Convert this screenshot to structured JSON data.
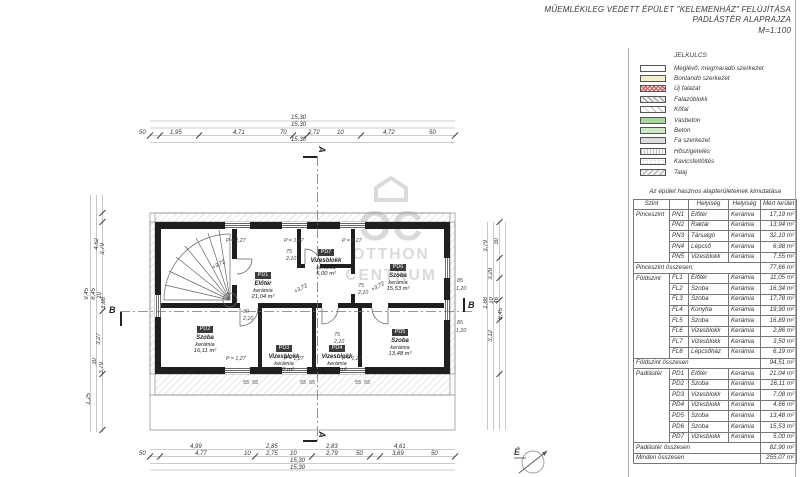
{
  "title": {
    "line1": "MŰEMLÉKILEG VÉDETT ÉPÜLET \"KELEMENHÁZ\" FELÚJÍTÁSA",
    "line2": "PADLÁSTÉR ALAPRAJZA",
    "line3": "M=1:100"
  },
  "legend": {
    "title": "JELKULCS",
    "items": [
      {
        "label": "Meglévő, megmaradó szerkezet",
        "swatch": "sw-existing"
      },
      {
        "label": "Bontandó szerkezet",
        "swatch": "sw-demolish"
      },
      {
        "label": "Új falazat",
        "swatch": "sw-newwall"
      },
      {
        "label": "Falazóblokk",
        "swatch": "sw-block"
      },
      {
        "label": "Kőfal",
        "swatch": "sw-stone"
      },
      {
        "label": "Vasbeton",
        "swatch": "sw-rc"
      },
      {
        "label": "Beton",
        "swatch": "sw-concrete"
      },
      {
        "label": "Fa szerkezet",
        "swatch": "sw-wood"
      },
      {
        "label": "Hőszigetelés",
        "swatch": "sw-insul"
      },
      {
        "label": "Kavicsfeltöltés",
        "swatch": "sw-gravel"
      },
      {
        "label": "Talaj",
        "swatch": "sw-soil"
      }
    ]
  },
  "area_table": {
    "title": "Az épület hasznos alapterületeinek kimutatása",
    "headers": [
      "Szint",
      "",
      "Helyiség",
      "Helyiség",
      "Mért terület"
    ],
    "rows": [
      {
        "cls": "group",
        "cells": [
          "Pinceszint",
          "PN1",
          "Előtér",
          "Kerámia",
          "17,19 m²"
        ]
      },
      {
        "cells": [
          "",
          "PN2",
          "Raktár",
          "Kerámia",
          "13,94 m²"
        ]
      },
      {
        "cells": [
          "",
          "PN3",
          "Társalgó",
          "Kerámia",
          "32,10 m²"
        ]
      },
      {
        "cells": [
          "",
          "PN4",
          "Lépcső",
          "Kerámia",
          "6,98 m²"
        ]
      },
      {
        "cells": [
          "",
          "PN5",
          "Vizesblokk",
          "Kerámia",
          "7,55 m²"
        ]
      },
      {
        "cls": "sub",
        "label": "Pinceszint összesen:",
        "value": "77,66 m²"
      },
      {
        "cls": "group",
        "cells": [
          "Földszint",
          "FL1",
          "Előtér",
          "Kerámia",
          "11,05 m²"
        ]
      },
      {
        "cells": [
          "",
          "FL2",
          "Szoba",
          "Kerámia",
          "16,34 m²"
        ]
      },
      {
        "cells": [
          "",
          "FL3",
          "Szoba",
          "Kerámia",
          "17,78 m²"
        ]
      },
      {
        "cells": [
          "",
          "FL4",
          "Konyha",
          "Kerámia",
          "19,90 m²"
        ]
      },
      {
        "cells": [
          "",
          "FL5",
          "Szoba",
          "Kerámia",
          "16,89 m²"
        ]
      },
      {
        "cells": [
          "",
          "FL6",
          "Vizesblokk",
          "Kerámia",
          "2,86 m²"
        ]
      },
      {
        "cells": [
          "",
          "FL7",
          "Vizesblokk",
          "Kerámia",
          "3,50 m²"
        ]
      },
      {
        "cells": [
          "",
          "FL8",
          "Lépcsőház",
          "Kerámia",
          "6,19 m²"
        ]
      },
      {
        "cls": "sub",
        "label": "Földszint összesen",
        "value": "94,51 m²"
      },
      {
        "cls": "group",
        "cells": [
          "Padlástér",
          "PD1",
          "Előtér",
          "Kerámia",
          "21,04 m²"
        ]
      },
      {
        "cells": [
          "",
          "PD2",
          "Szoba",
          "Kerámia",
          "16,11 m²"
        ]
      },
      {
        "cells": [
          "",
          "PD3",
          "Vizesblokk",
          "Kerámia",
          "7,08 m²"
        ]
      },
      {
        "cells": [
          "",
          "PD4",
          "Vizesblokk",
          "Kerámia",
          "4,66 m²"
        ]
      },
      {
        "cells": [
          "",
          "PD5",
          "Szoba",
          "Kerámia",
          "13,48 m²"
        ]
      },
      {
        "cells": [
          "",
          "PD6",
          "Szoba",
          "Kerámia",
          "15,53 m²"
        ]
      },
      {
        "cells": [
          "",
          "PD7",
          "Vizesblokk",
          "Kerámia",
          "5,00 m²"
        ]
      },
      {
        "cls": "sub",
        "label": "Padlástér összesen",
        "value": "82,90 m²"
      },
      {
        "cls": "total",
        "label": "Minden összesen",
        "value": "255,07 m²"
      }
    ]
  },
  "plan": {
    "rooms": [
      {
        "code": "PD1",
        "name": "Előtér",
        "finish": "kerámia",
        "area": "21,04 m²"
      },
      {
        "code": "PD2",
        "name": "Szoba",
        "finish": "kerámia",
        "area": "16,11 m²"
      },
      {
        "code": "PD3",
        "name": "Vizesblokk",
        "finish": "kerámia",
        "area": "7,08 m²"
      },
      {
        "code": "PD4",
        "name": "Vizesblokk",
        "finish": "kerámia",
        "area": "4,66 m²"
      },
      {
        "code": "PD5",
        "name": "Szoba",
        "finish": "kerámia",
        "area": "13,48 m²"
      },
      {
        "code": "PD6",
        "name": "Szoba",
        "finish": "kerámia",
        "area": "15,53 m²"
      },
      {
        "code": "PD7",
        "name": "Vizesblokk",
        "finish": "kerámia",
        "area": "5,00 m²"
      }
    ],
    "dims_top": [
      "50",
      "1,95",
      "4,71",
      "70",
      "2,72",
      "10",
      "4,72",
      "50"
    ],
    "dims_top_total": [
      "15,30",
      "15,30",
      "15,30"
    ],
    "dims_bottom1": [
      "4,99",
      "2,85",
      "2,83",
      "4,61"
    ],
    "dims_bottom2": [
      "50",
      "4,77",
      "10",
      "2,75",
      "10",
      "2,79",
      "50",
      "3,69",
      "50"
    ],
    "dims_bottom_total": [
      "15,30",
      "15,30"
    ],
    "dims_left": [
      "9,45",
      "8,45",
      "4,52",
      "3,79",
      "10",
      "1,88",
      "3,27",
      "30",
      "3,79",
      "1,25"
    ],
    "dims_right": [
      "3,79",
      "30",
      "3,29",
      "1,88",
      "10",
      "46",
      "8,45",
      "3,12"
    ],
    "dims_right_small": [
      "85",
      "1,20",
      "85",
      "1,20"
    ],
    "inner": {
      "p": "P =  1,27",
      "level": "+3,72",
      "d55": "55",
      "d90": "90",
      "d210": "2,10",
      "d75": "75"
    },
    "markers": {
      "a": "A",
      "b": "B"
    },
    "north_label": "É",
    "watermark": {
      "brand": "OC",
      "line1": "OTTHON",
      "line2": "CENTRUM"
    }
  }
}
